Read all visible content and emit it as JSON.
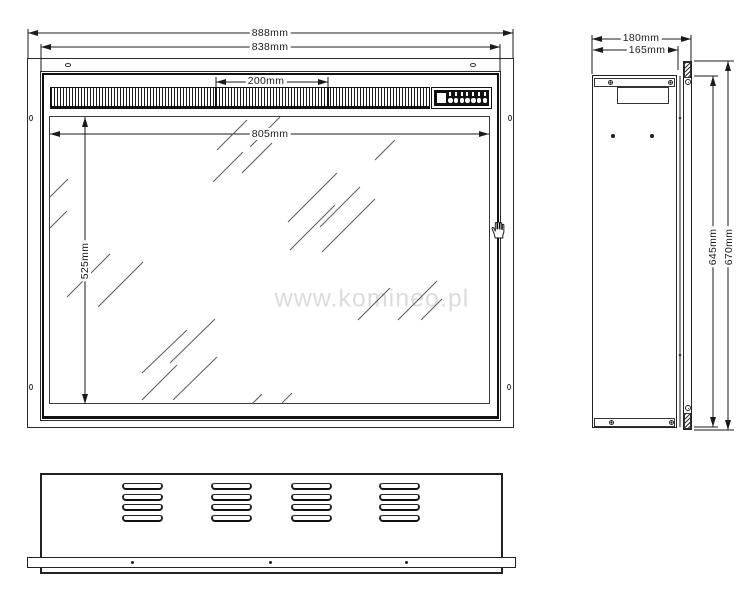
{
  "watermark": {
    "text": "www.komineo.pl",
    "color": "#dcdcdc"
  },
  "drawing": {
    "line_color": "#1b1b1b",
    "cursor": {
      "icon": "hand-cursor"
    },
    "views": {
      "front": {
        "dimensions": {
          "overall_width": "888mm",
          "inner_width": "838mm",
          "grille_section_width": "200mm",
          "glass_width": "805mm",
          "glass_height": "525mm"
        }
      },
      "side": {
        "dimensions": {
          "overall_depth": "180mm",
          "body_depth": "165mm",
          "body_height": "645mm",
          "overall_height": "670mm"
        }
      }
    }
  }
}
